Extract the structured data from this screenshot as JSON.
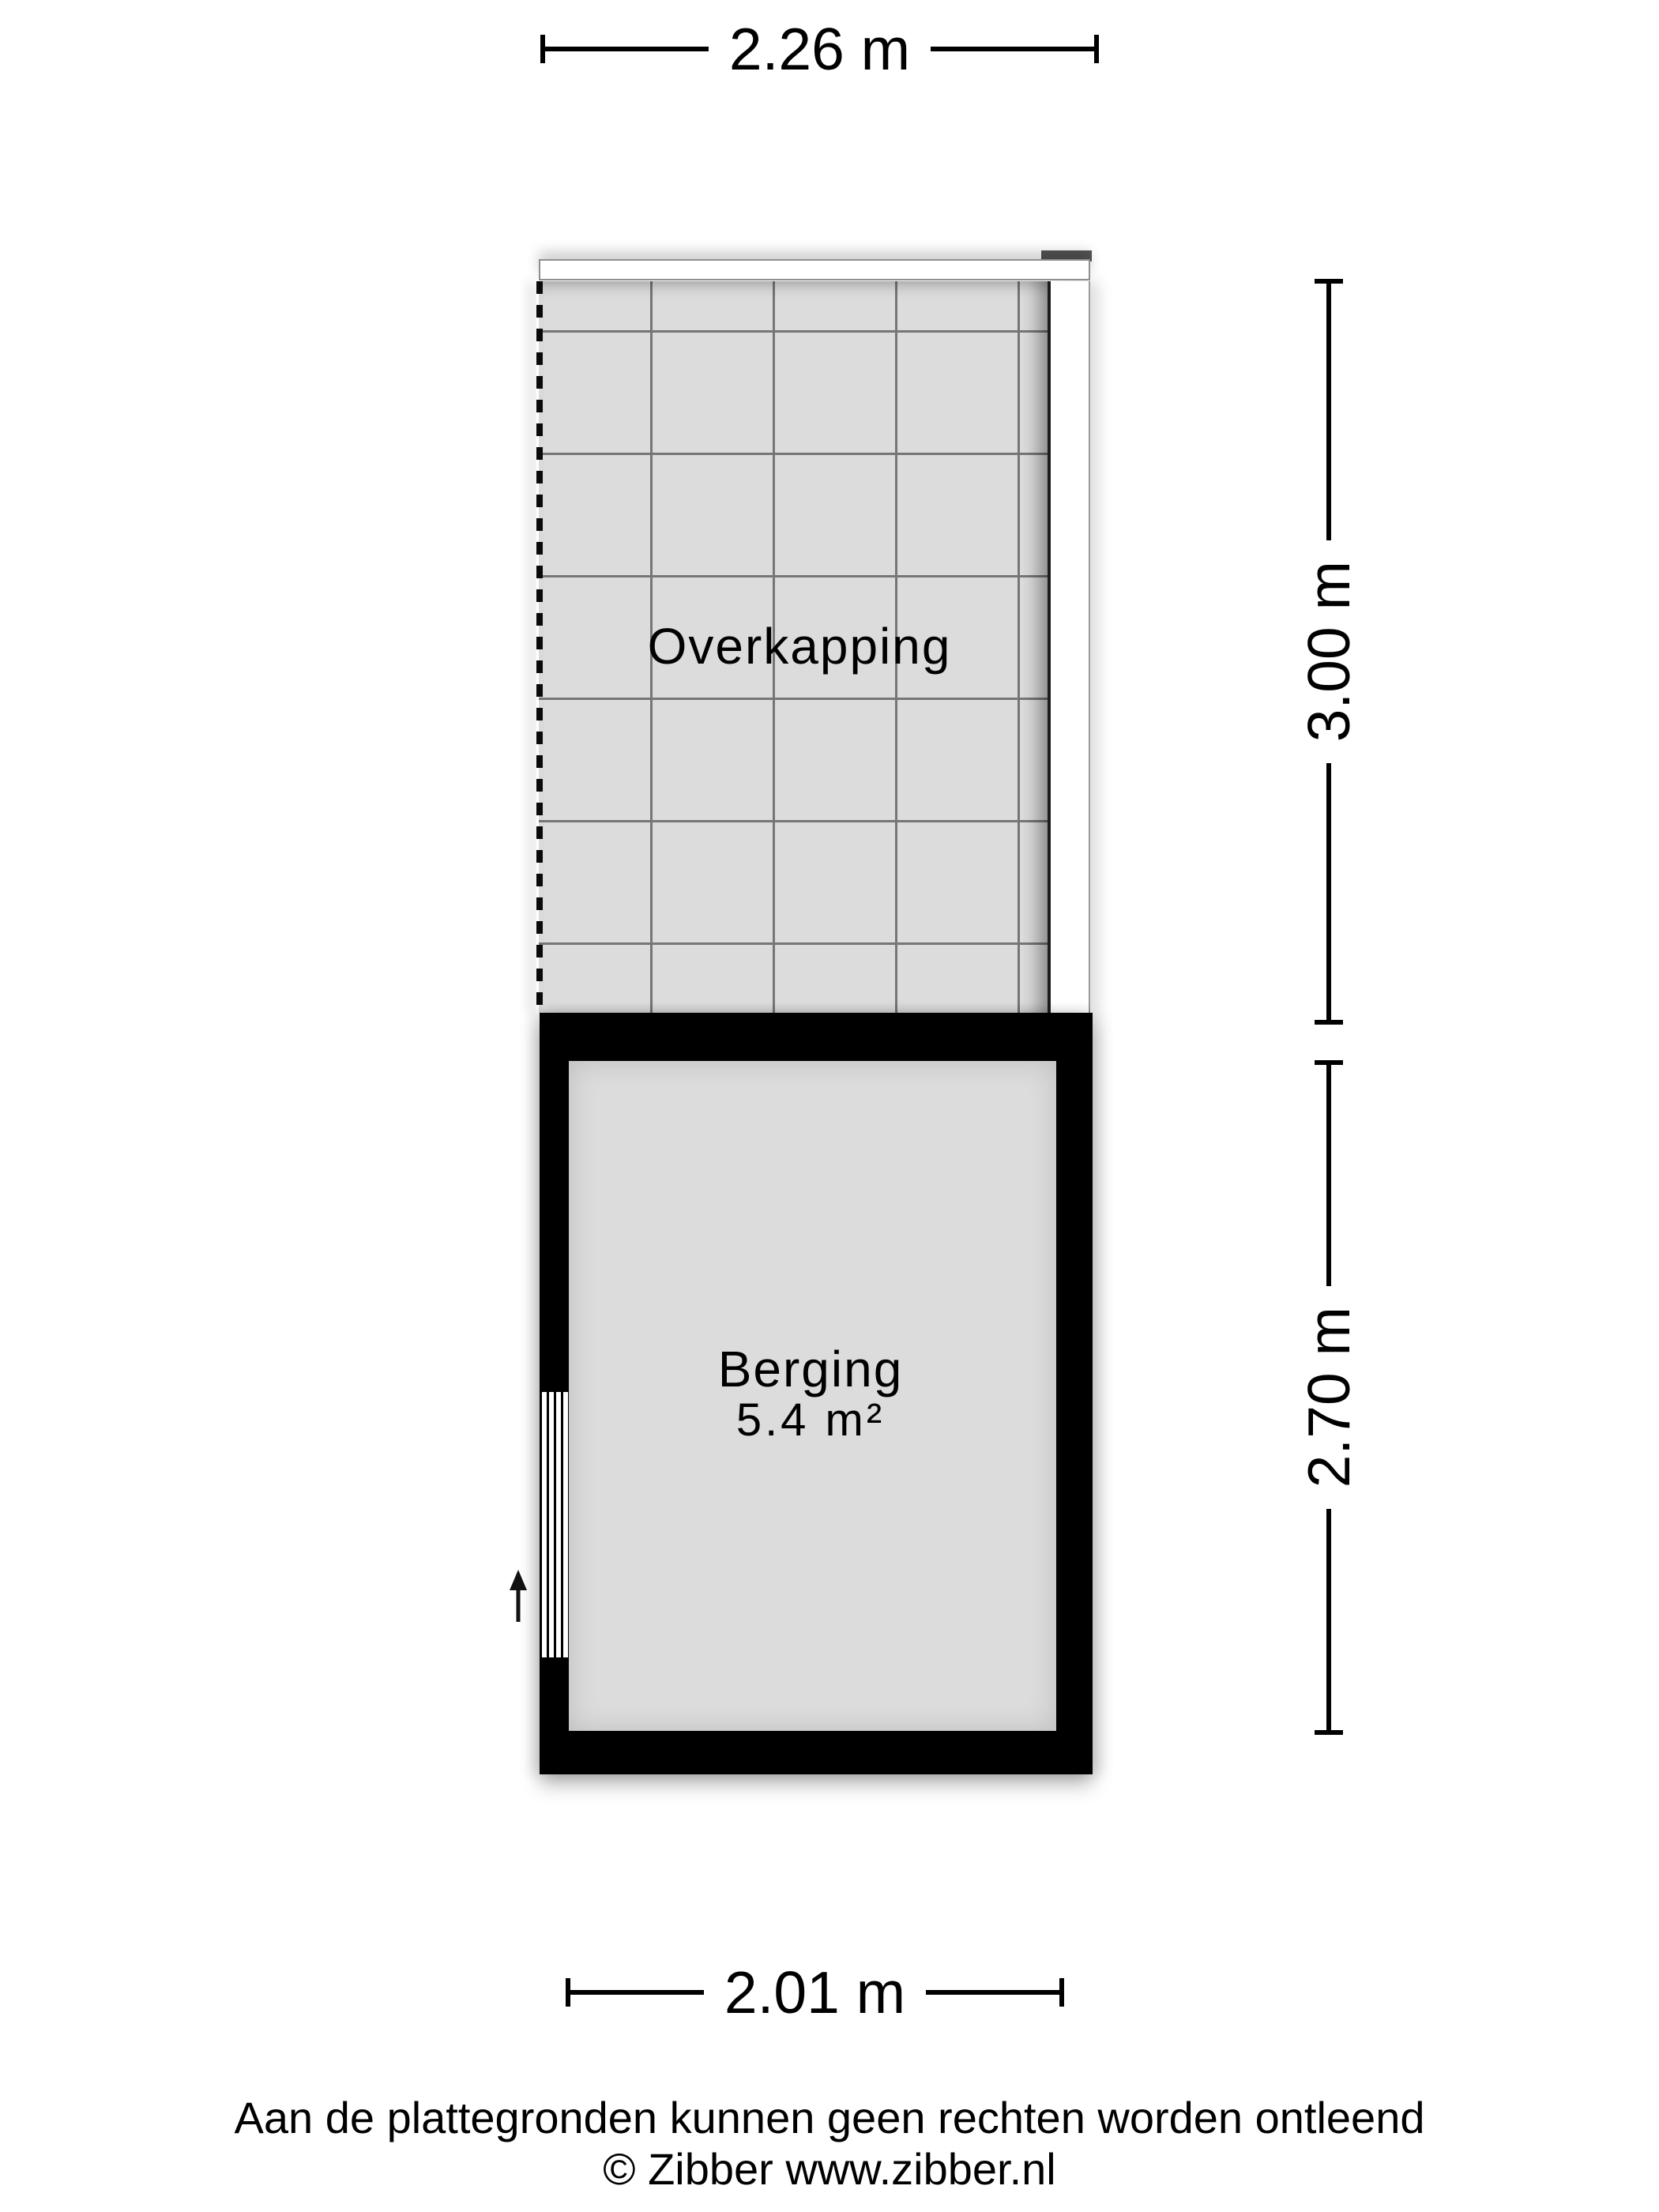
{
  "plan": {
    "dimensions": {
      "top": "2.26 m",
      "right_upper": "3.00 m",
      "right_lower": "2.70 m",
      "bottom": "2.01 m"
    },
    "rooms": {
      "overkapping": {
        "label": "Overkapping"
      },
      "berging": {
        "label": "Berging",
        "area": "5.4 m²"
      }
    },
    "icons": {
      "entrance_arrow": "up-arrow"
    }
  },
  "footer": {
    "line1": "Aan de plattegronden kunnen geen rechten worden ontleend",
    "line2": "© Zibber www.zibber.nl"
  },
  "colors": {
    "wall": "#000000",
    "floor": "#dcdcdc",
    "grid_line": "#767676",
    "text": "#000000",
    "canopy_beam": "#ffffff",
    "corner_cap": "#545454"
  }
}
